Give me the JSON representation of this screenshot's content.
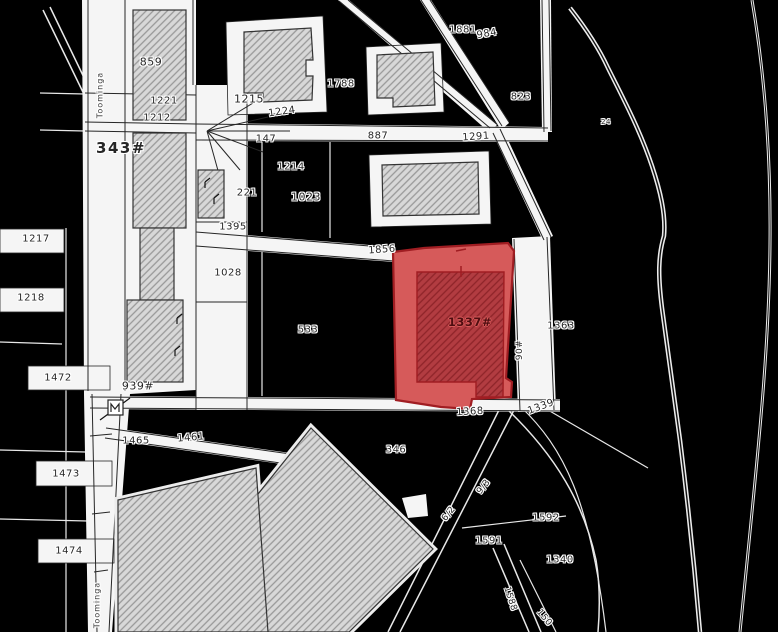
{
  "map": {
    "colors": {
      "background": "#000000",
      "paper": "#f5f5f5",
      "line": "#262626",
      "building_fill": "#d8d8d8",
      "building_hatch": "#989898",
      "highlight_fill": "#d65a5a",
      "highlight_building": "#b23c41",
      "highlight_hatch": "#8e2429",
      "highlight_border": "#a01d22",
      "highlight_label": "#4e0d10"
    },
    "highlight_parcel": {
      "label": "1337#"
    },
    "labels": [
      {
        "t": "859",
        "x": 151,
        "y": 62,
        "s": 11
      },
      {
        "t": "1221",
        "x": 164,
        "y": 101,
        "s": 10
      },
      {
        "t": "1212",
        "x": 157,
        "y": 118,
        "s": 10
      },
      {
        "t": "343#",
        "x": 121,
        "y": 148,
        "s": 15,
        "c": "big"
      },
      {
        "t": "1215",
        "x": 249,
        "y": 99,
        "s": 11
      },
      {
        "t": "1224",
        "x": 282,
        "y": 112,
        "s": 10,
        "r": -8
      },
      {
        "t": "147",
        "x": 266,
        "y": 139,
        "s": 10
      },
      {
        "t": "1214",
        "x": 291,
        "y": 167,
        "s": 10
      },
      {
        "t": "221",
        "x": 247,
        "y": 193,
        "s": 10
      },
      {
        "t": "1023",
        "x": 306,
        "y": 197,
        "s": 11
      },
      {
        "t": "1395",
        "x": 233,
        "y": 227,
        "s": 10
      },
      {
        "t": "1028",
        "x": 228,
        "y": 273,
        "s": 10
      },
      {
        "t": "1788",
        "x": 341,
        "y": 84,
        "s": 10
      },
      {
        "t": "887",
        "x": 378,
        "y": 136,
        "s": 10
      },
      {
        "t": "1291",
        "x": 476,
        "y": 137,
        "s": 10,
        "r": -4
      },
      {
        "t": "1881",
        "x": 463,
        "y": 30,
        "s": 10
      },
      {
        "t": "984",
        "x": 487,
        "y": 34,
        "s": 10,
        "r": -10
      },
      {
        "t": "823",
        "x": 521,
        "y": 97,
        "s": 10
      },
      {
        "t": "1856",
        "x": 382,
        "y": 250,
        "s": 10,
        "r": -4
      },
      {
        "t": "1337#",
        "x": 470,
        "y": 322,
        "s": 11.5,
        "c": "red"
      },
      {
        "t": "1363",
        "x": 561,
        "y": 326,
        "s": 10
      },
      {
        "t": "90#",
        "x": 520,
        "y": 350,
        "s": 9,
        "r": -90
      },
      {
        "t": "1368",
        "x": 470,
        "y": 412,
        "s": 10,
        "r": -3
      },
      {
        "t": "1339",
        "x": 541,
        "y": 407,
        "s": 10,
        "r": -20
      },
      {
        "t": "346",
        "x": 396,
        "y": 450,
        "s": 10
      },
      {
        "t": "533",
        "x": 308,
        "y": 330,
        "s": 10
      },
      {
        "t": "1592",
        "x": 546,
        "y": 518,
        "s": 10
      },
      {
        "t": "1591",
        "x": 489,
        "y": 541,
        "s": 10
      },
      {
        "t": "1340",
        "x": 560,
        "y": 560,
        "s": 10
      },
      {
        "t": "1588",
        "x": 510,
        "y": 599,
        "s": 9,
        "r": 72
      },
      {
        "t": "150",
        "x": 544,
        "y": 618,
        "s": 9,
        "r": 50
      },
      {
        "t": "6/2",
        "x": 449,
        "y": 514,
        "s": 9,
        "r": -52
      },
      {
        "t": "9/3",
        "x": 484,
        "y": 487,
        "s": 9,
        "r": -52
      },
      {
        "t": "1217",
        "x": 36,
        "y": 239,
        "s": 10
      },
      {
        "t": "1218",
        "x": 31,
        "y": 298,
        "s": 10
      },
      {
        "t": "1472",
        "x": 58,
        "y": 378,
        "s": 10
      },
      {
        "t": "1473",
        "x": 66,
        "y": 474,
        "s": 10
      },
      {
        "t": "1474",
        "x": 69,
        "y": 551,
        "s": 10
      },
      {
        "t": "939#",
        "x": 138,
        "y": 386,
        "s": 11
      },
      {
        "t": "1465",
        "x": 136,
        "y": 441,
        "s": 10
      },
      {
        "t": "1461",
        "x": 191,
        "y": 438,
        "s": 10,
        "r": -5
      },
      {
        "t": "24",
        "x": 606,
        "y": 122,
        "s": 7
      },
      {
        "t": "Toominga",
        "x": 100,
        "y": 95,
        "s": 8,
        "r": -90,
        "c": "street"
      },
      {
        "t": "Toominga",
        "x": 97,
        "y": 605,
        "s": 8,
        "r": -90,
        "c": "street"
      }
    ]
  }
}
